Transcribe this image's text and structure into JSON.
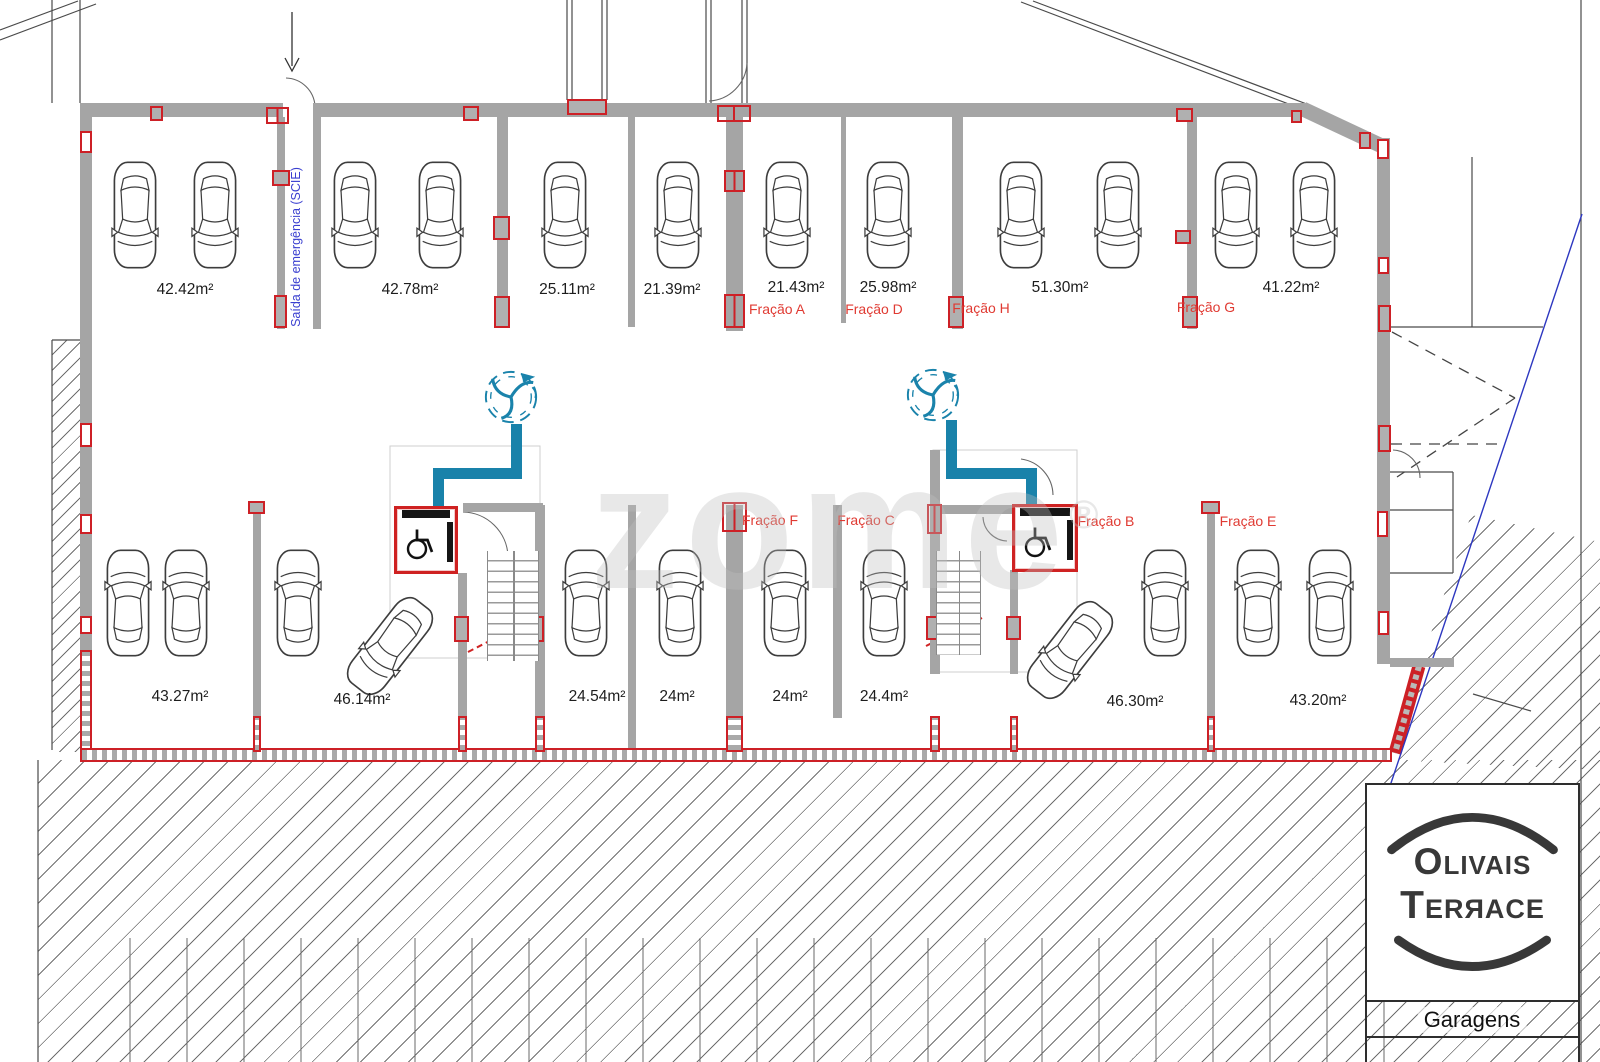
{
  "title_block": {
    "logo_line1": "Olivais",
    "logo_line2": "Terяace",
    "caption": "Garagens"
  },
  "watermark": {
    "text": "zome",
    "reg": "®"
  },
  "emergency_exit_label": "Saída de emergência (SCIE)",
  "top_bays": [
    {
      "area": "42.42m²"
    },
    {
      "area": "42.78m²"
    },
    {
      "area": "25.11m²"
    },
    {
      "area": "21.39m²"
    },
    {
      "area": "21.43m²",
      "fraction": "Fração A"
    },
    {
      "area": "25.98m²",
      "fraction": "Fração D"
    },
    {
      "area": "51.30m²",
      "fraction": "Fração H"
    },
    {
      "area": "41.22m²",
      "fraction": "Fração G"
    }
  ],
  "bottom_bays": [
    {
      "area": "43.27m²"
    },
    {
      "area": "46.14m²"
    },
    {
      "area": "24.54m²"
    },
    {
      "area": "24m²"
    },
    {
      "area": "24m²"
    },
    {
      "area": "24.4m²"
    },
    {
      "area": "46.30m²"
    },
    {
      "area": "43.20m²"
    }
  ],
  "mid_fractions": [
    "Fração F",
    "Fração C",
    "Fração B",
    "Fração E"
  ],
  "colors": {
    "wall_gray": "#a5a5a5",
    "fire_red": "#cd2026",
    "vent_teal": "#1982aa",
    "exit_blue": "#3a3fd0",
    "label_red": "#e03a32"
  }
}
